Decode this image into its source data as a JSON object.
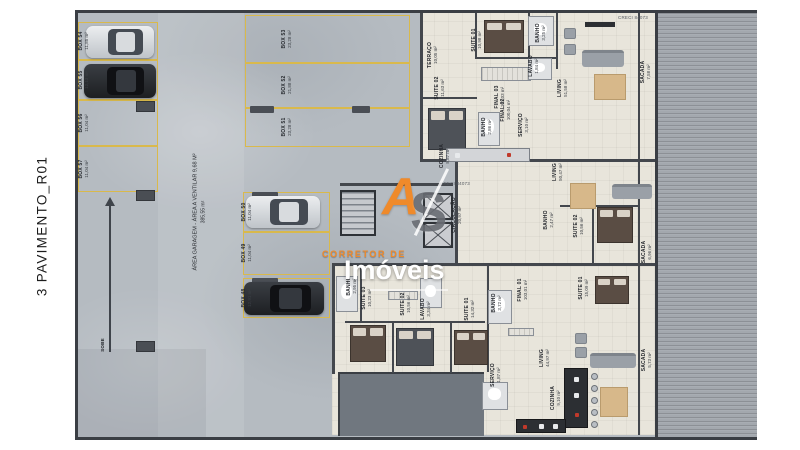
{
  "title": "3 PAVIMENTO_R01",
  "watermark": {
    "logo_a": "A",
    "logo_s": "S",
    "tagline": "CORRETOR DE",
    "brand": "Imóveis"
  },
  "stamps": {
    "creci": "CRECI 84073"
  },
  "garage": {
    "area_label": "ÁREA GARAGEM - ÁREA A VENTILAR 9,68 M²",
    "area_value": "385,55 m²",
    "ramp_label": "SOBE",
    "boxes": [
      {
        "name": "BOX 54",
        "area": "11,85 m²"
      },
      {
        "name": "BOX 55",
        "area": "12,13 m²"
      },
      {
        "name": "BOX 56",
        "area": "11,04 m²"
      },
      {
        "name": "BOX 57",
        "area": "11,04 m²"
      },
      {
        "name": "BOX 53",
        "area": "23,28 m²"
      },
      {
        "name": "BOX 52",
        "area": "21,88 m²"
      },
      {
        "name": "BOX 51",
        "area": "23,28 m²"
      },
      {
        "name": "BOX 50",
        "area": "11,04 m²"
      },
      {
        "name": "BOX 49",
        "area": "11,04 m²"
      },
      {
        "name": "BOX 48",
        "area": "12,91 m²"
      }
    ]
  },
  "core": {
    "circulation": {
      "name": "CIRCULAÇÃO",
      "area": "20,97 m²"
    }
  },
  "rooms": [
    {
      "name": "TERRAÇO",
      "area": "10,05 m²"
    },
    {
      "name": "SUITE 02",
      "area": "11,63 m²"
    },
    {
      "name": "SUITE 01",
      "area": "10,98 m²"
    },
    {
      "name": "BANHO",
      "area": "3,25 m²"
    },
    {
      "name": "LAVABO",
      "area": "1,84 m²"
    },
    {
      "name": "LIVING",
      "area": "51,58 m²"
    },
    {
      "name": "SACADA",
      "area": "7,58 m²"
    },
    {
      "name": "FINAL 03",
      "area": "101,03 m²"
    },
    {
      "name": "BANHO",
      "area": "2,86 m²"
    },
    {
      "name": "COZINHA",
      "area": "8,87 m²"
    },
    {
      "name": "FINAL 02",
      "area": "100,04 m²"
    },
    {
      "name": "SERVIÇO",
      "area": "3,10 m²"
    },
    {
      "name": "LIVING",
      "area": "50,47 m²"
    },
    {
      "name": "BANHO",
      "area": "2,47 m²"
    },
    {
      "name": "SUITE 02",
      "area": "10,56 m²"
    },
    {
      "name": "SACADA",
      "area": "6,96 m²"
    },
    {
      "name": "SUITE 01",
      "area": "15,09 m²"
    },
    {
      "name": "FINAL 01",
      "area": "103,01 m²"
    },
    {
      "name": "BANHO",
      "area": "3,72 m²"
    },
    {
      "name": "SERVIÇO",
      "area": "1,87 m²"
    },
    {
      "name": "LIVING",
      "area": "44,97 m²"
    },
    {
      "name": "SACADA",
      "area": "5,73 m²"
    },
    {
      "name": "BANHO",
      "area": "2,95 m²"
    },
    {
      "name": "SUITE 03",
      "area": "10,23 m²"
    },
    {
      "name": "SUITE 02",
      "area": "10,56 m²"
    },
    {
      "name": "LAVABO",
      "area": "3,34 m²"
    },
    {
      "name": "SUITE 01",
      "area": "14,32 m²"
    },
    {
      "name": "COZINHA",
      "area": "9,10 m²"
    }
  ]
}
